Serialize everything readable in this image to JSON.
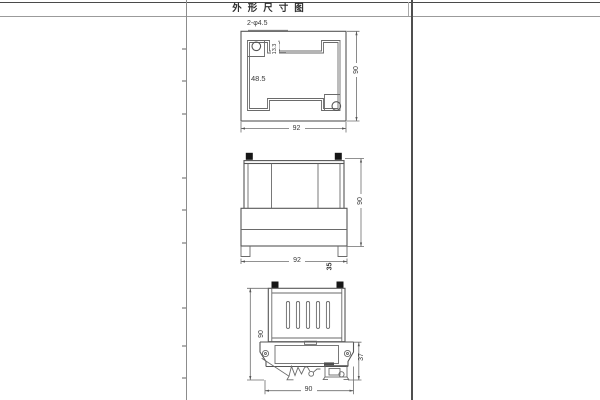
{
  "title_bar": {
    "title": "外形尺寸图"
  },
  "top_view": {
    "hole_label": "2-φ4.5",
    "dim_notch_depth": "13.3",
    "dim_inner": "48.5",
    "dim_width": "92",
    "dim_height": "90"
  },
  "front_view": {
    "dim_width": "92",
    "dim_height": "90",
    "dim_depth": "35"
  },
  "side_view": {
    "dim_height": "90",
    "dim_clip_height": "37",
    "dim_width": "90"
  }
}
